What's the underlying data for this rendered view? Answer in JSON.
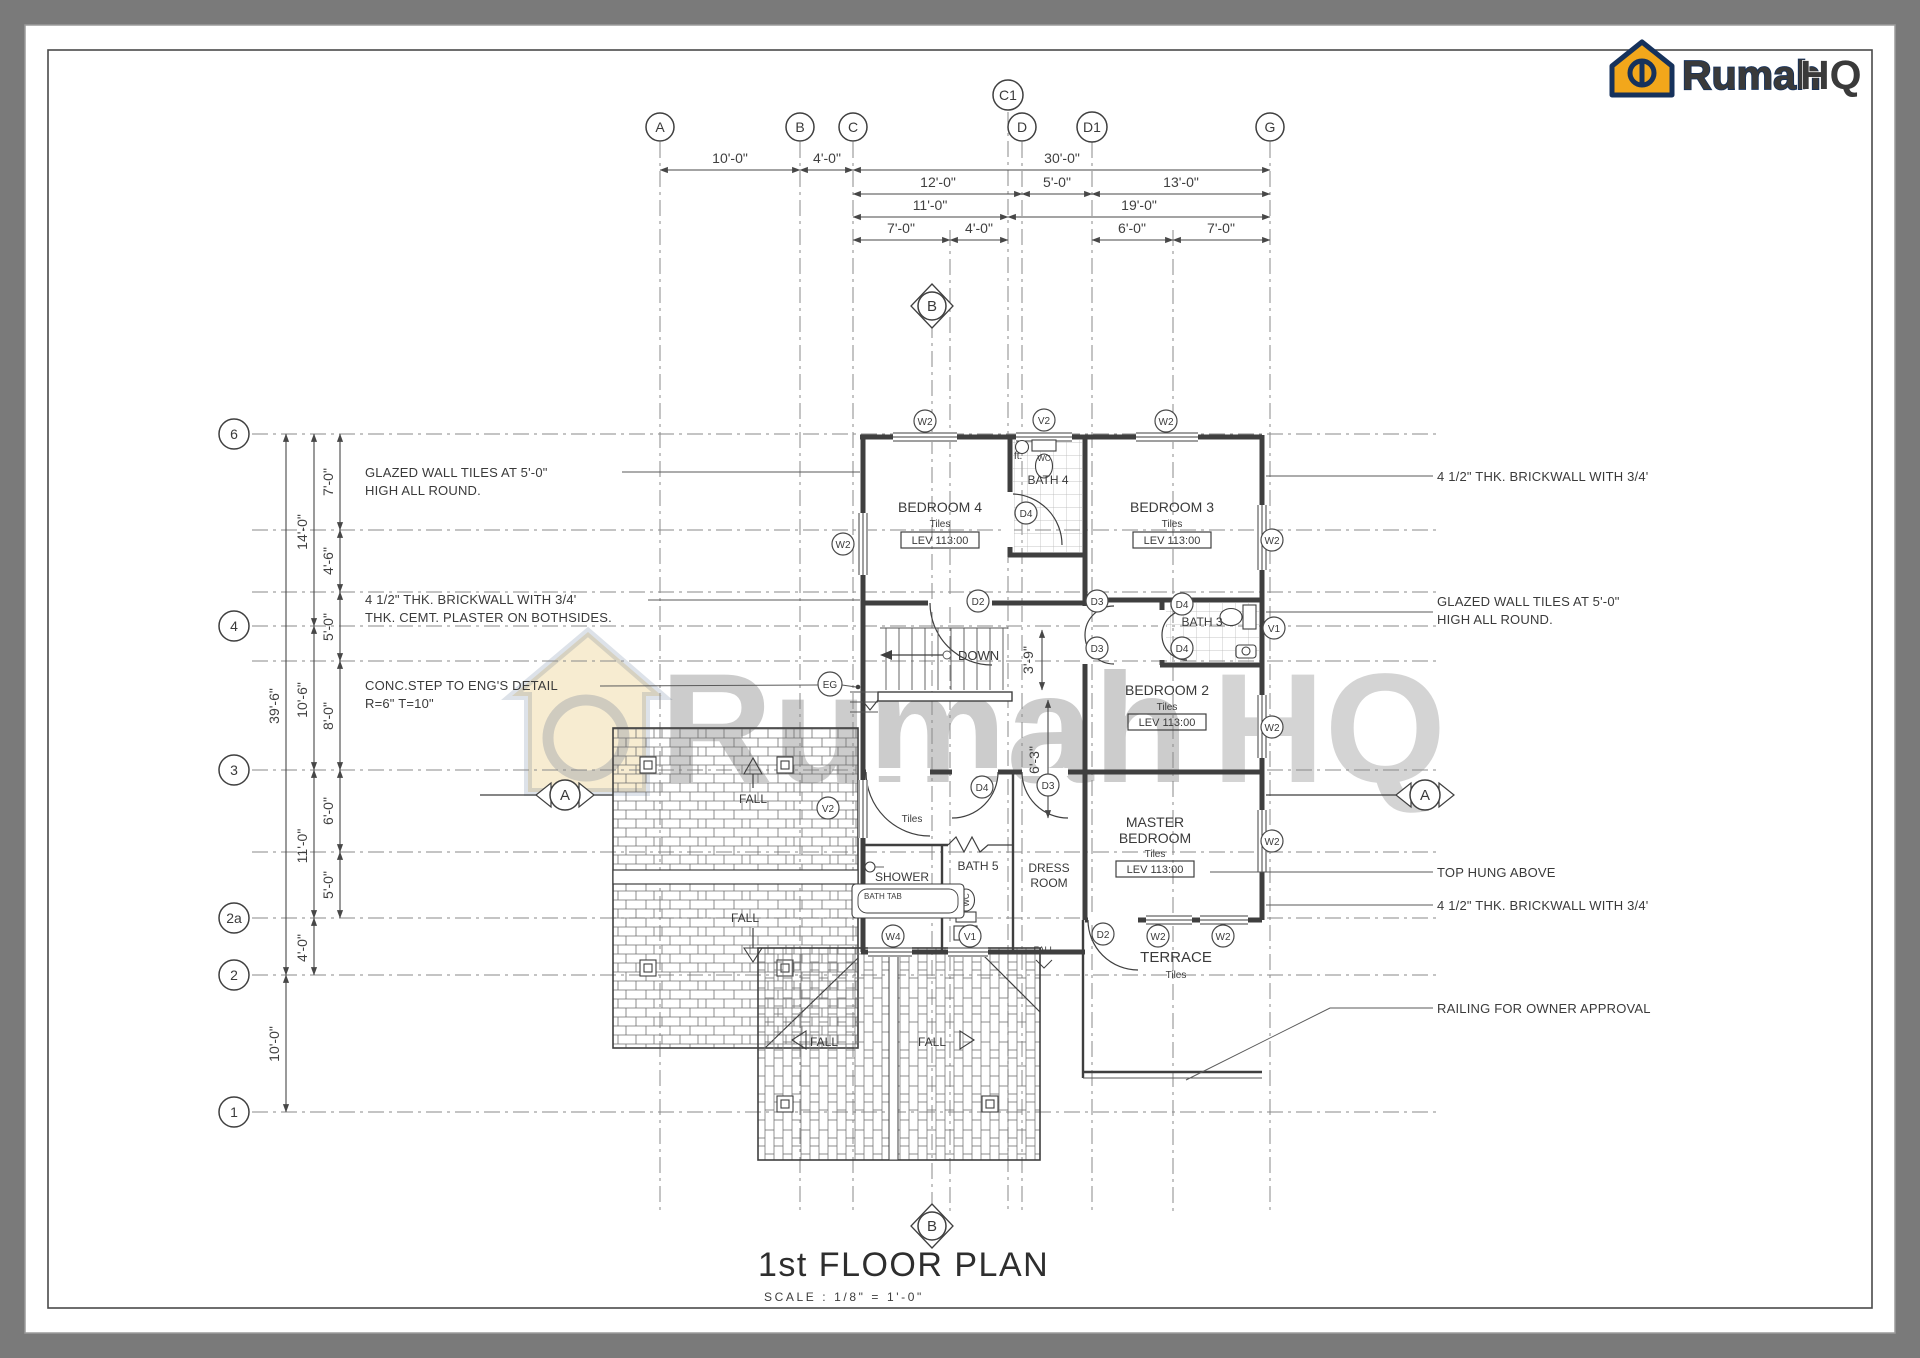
{
  "sheet": {
    "background": "#7a7a7a",
    "paper": "#ffffff",
    "line_color": "#3f3f3f"
  },
  "logo": {
    "rumah": "Rumah",
    "hq": "HQ",
    "gold": "#f2a71b",
    "navy": "#16325c"
  },
  "watermark": {
    "rumah": "Rumah",
    "hq": "HQ"
  },
  "title": {
    "name": "1st FLOOR PLAN",
    "scale": "SCALE : 1/8\" = 1'-0\""
  },
  "grid": {
    "top": [
      "A",
      "B",
      "C",
      "C1",
      "D",
      "D1",
      "G"
    ],
    "left": [
      "6",
      "4",
      "3",
      "2a",
      "2",
      "1"
    ]
  },
  "dims": {
    "top_row1": [
      "10'-0\"",
      "4'-0\"",
      "30'-0\""
    ],
    "top_row2": [
      "12'-0\"",
      "5'-0\"",
      "13'-0\""
    ],
    "top_row3": [
      "11'-0\"",
      "19'-0\""
    ],
    "top_row4": [
      "7'-0\"",
      "4'-0\"",
      "6'-0\"",
      "7'-0\""
    ],
    "left_total": "39'-6\"",
    "left_mid": [
      "14'-0\"",
      "10'-6\"",
      "11'-0\"",
      "4'-0\""
    ],
    "left_bottom": "10'-0\"",
    "left_inner": [
      "7'-0\"",
      "4'-6\"",
      "5'-0\"",
      "8'-0\"",
      "6'-0\"",
      "5'-0\""
    ],
    "stair": [
      "3'-9\"",
      "6'-3\""
    ]
  },
  "rooms": {
    "bedroom4": {
      "name": "BEDROOM 4",
      "finish": "Tiles",
      "level": "LEV 113:00"
    },
    "bedroom3": {
      "name": "BEDROOM 3",
      "finish": "Tiles",
      "level": "LEV 113:00"
    },
    "bedroom2": {
      "name": "BEDROOM 2",
      "finish": "Tiles",
      "level": "LEV 113:00"
    },
    "master": {
      "name_line1": "MASTER",
      "name_line2": "BEDROOM",
      "finish": "Tiles",
      "level": "LEV 113:00"
    },
    "bath4": "BATH 4",
    "bath3": "BATH 3",
    "bath5": "BATH 5",
    "shower": "SHOWER",
    "dress": {
      "line1": "DRESS",
      "line2": "ROOM"
    },
    "terrace": {
      "name": "TERRACE",
      "finish": "Tiles"
    },
    "hall_finish": "Tiles"
  },
  "labels": {
    "down": "DOWN",
    "fall": "FALL",
    "bath_tab": "BATH  TAB",
    "wc": "WC",
    "ft": "ft."
  },
  "tags": {
    "w2": "W2",
    "v2": "V2",
    "v1": "V1",
    "w4": "W4",
    "d2": "D2",
    "d3": "D3",
    "d4": "D4",
    "eg": "EG",
    "section_a": "A",
    "section_b": "B"
  },
  "notes": {
    "left1a": "GLAZED WALL TILES AT 5'-0\"",
    "left1b": "HIGH ALL ROUND.",
    "left2a": "4 1/2\" THK. BRICKWALL WITH 3/4'",
    "left2b": "THK. CEMT. PLASTER ON BOTHSIDES.",
    "left3a": "CONC.STEP TO ENG'S DETAIL",
    "left3b": "R=6\" T=10\"",
    "right1": "4 1/2\" THK. BRICKWALL WITH 3/4'",
    "right2a": "GLAZED WALL TILES AT 5'-0\"",
    "right2b": "HIGH ALL ROUND.",
    "right3": "TOP HUNG ABOVE",
    "right4": "4 1/2\" THK. BRICKWALL WITH 3/4'",
    "right5": "RAILING FOR OWNER APPROVAL"
  }
}
